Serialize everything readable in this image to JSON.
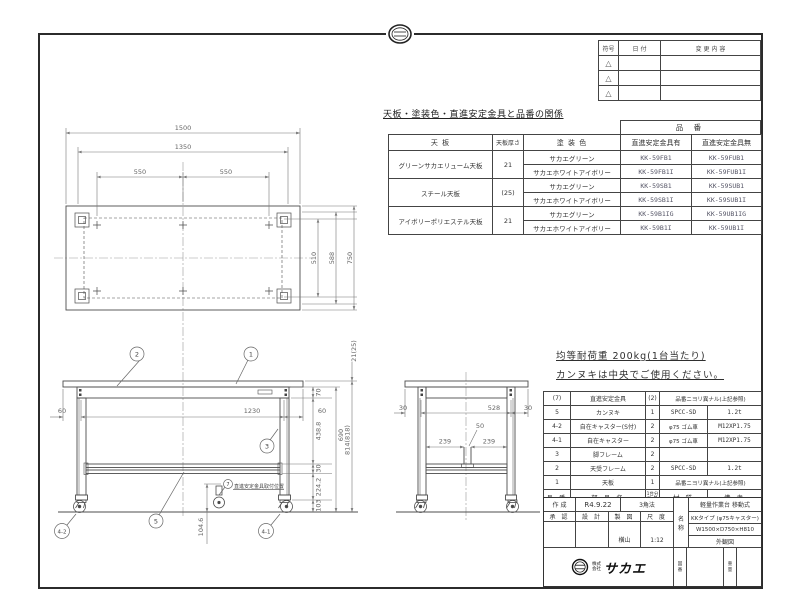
{
  "revision_table": {
    "headers": {
      "symbol": "符号",
      "date": "日 付",
      "change": "変 更 内 容"
    },
    "rows": [
      {
        "symbol": "△"
      },
      {
        "symbol": "△"
      },
      {
        "symbol": "△"
      }
    ]
  },
  "product_table": {
    "title": "天板・塗装色・直進安定金具と品番の関係",
    "part_no_header": "品 番",
    "headers": {
      "top": "天 板",
      "thickness": "天板厚さ",
      "color": "塗 装 色",
      "with_bracket": "直進安定金具有",
      "without_bracket": "直進安定金具無"
    },
    "rows": [
      {
        "top": "グリーンサカエリューム天板",
        "thickness": "21",
        "color": "サカエグリーン",
        "with": "KK-59FB1",
        "without": "KK-59FUB1"
      },
      {
        "color": "サカエホワイトアイボリー",
        "with": "KK-59FB1I",
        "without": "KK-59FUB1I"
      },
      {
        "top": "スチール天板",
        "thickness": "(25)",
        "color": "サカエグリーン",
        "with": "KK-59SB1",
        "without": "KK-59SUB1"
      },
      {
        "color": "サカエホワイトアイボリー",
        "with": "KK-59SB1I",
        "without": "KK-59SUB1I"
      },
      {
        "top": "アイボリーポリエステル天板",
        "thickness": "21",
        "color": "サカエグリーン",
        "with": "KK-59B1IG",
        "without": "KK-59UB1IG"
      },
      {
        "color": "サカエホワイトアイボリー",
        "with": "KK-59B1I",
        "without": "KK-59UB1I"
      }
    ]
  },
  "notes": {
    "line1": "均等耐荷重  200kg(1台当たり)",
    "line2": "カンヌキは中央でご使用ください。"
  },
  "parts_table": {
    "headers": {
      "no": "品 番",
      "name": "部 品 名",
      "qty_l1": "1台分",
      "qty_l2": "数 量",
      "material": "材 質",
      "note": "備 考"
    },
    "rows": [
      {
        "no": "(7)",
        "name": "直進安定金具",
        "qty": "(2)",
        "material": "品番ニヨリ異ナル(上記参照)",
        "note": ""
      },
      {
        "no": "5",
        "name": "カンヌキ",
        "qty": "1",
        "material": "SPCC-SD",
        "note": "1.2t"
      },
      {
        "no": "4-2",
        "name": "自在キャスター(S付)",
        "qty": "2",
        "material": "φ75 ゴム車",
        "note": "M12XP1.75"
      },
      {
        "no": "4-1",
        "name": "自在キャスター",
        "qty": "2",
        "material": "φ75 ゴム車",
        "note": "M12XP1.75"
      },
      {
        "no": "3",
        "name": "脚フレーム",
        "qty": "2",
        "material": "",
        "note": ""
      },
      {
        "no": "2",
        "name": "天受フレーム",
        "qty": "2",
        "material": "SPCC-SD",
        "note": "1.2t"
      },
      {
        "no": "1",
        "name": "天板",
        "qty": "1",
        "material": "品番ニヨリ異ナル(上記参照)",
        "note": ""
      }
    ]
  },
  "title_block": {
    "created_label": "作 成",
    "created_date": "R4.9.22",
    "projection": "3角法",
    "approved_label": "承 認",
    "designed_label": "設 計",
    "drawn_label": "製 図",
    "scale_label": "尺 度",
    "drawn_by": "横山",
    "scale": "1:12",
    "name_label_1": "名",
    "name_label_2": "称",
    "product_line1": "軽量作業台 移動式",
    "product_line2": "KKタイプ (φ75キャスター)",
    "product_line3": "W1500×D750×H810",
    "product_line4": "外観図",
    "company_prefix1": "株式",
    "company_prefix2": "会社",
    "company_name": "サカエ",
    "drawing_no_label_1": "図",
    "drawing_no_label_2": "番",
    "weight_label_1": "重",
    "weight_label_2": "量"
  },
  "drawing": {
    "top_view": {
      "w1500": "1500",
      "w1350": "1350",
      "w550a": "550",
      "w550b": "550",
      "d510": "510",
      "d588": "588",
      "d750": "750"
    },
    "front_view": {
      "oh_l": "60",
      "span": "1230",
      "oh_r": "60",
      "thick": "21(25)",
      "apron": "70",
      "leg_u": "438.8",
      "rail": "30",
      "leg_l": "224.2",
      "caster": "103",
      "under": "690",
      "height": "814(818)",
      "bracket_h": "104.6",
      "bracket_note": "直進安定金具取付位置",
      "b1": "1",
      "b2": "2",
      "b3": "3",
      "b5": "5",
      "b41": "4-1",
      "b42": "4-2",
      "b7": "7"
    },
    "side_view": {
      "oh_l": "30",
      "span": "528",
      "oh_r": "30",
      "slot": "50",
      "l239": "239",
      "r239": "239"
    }
  }
}
